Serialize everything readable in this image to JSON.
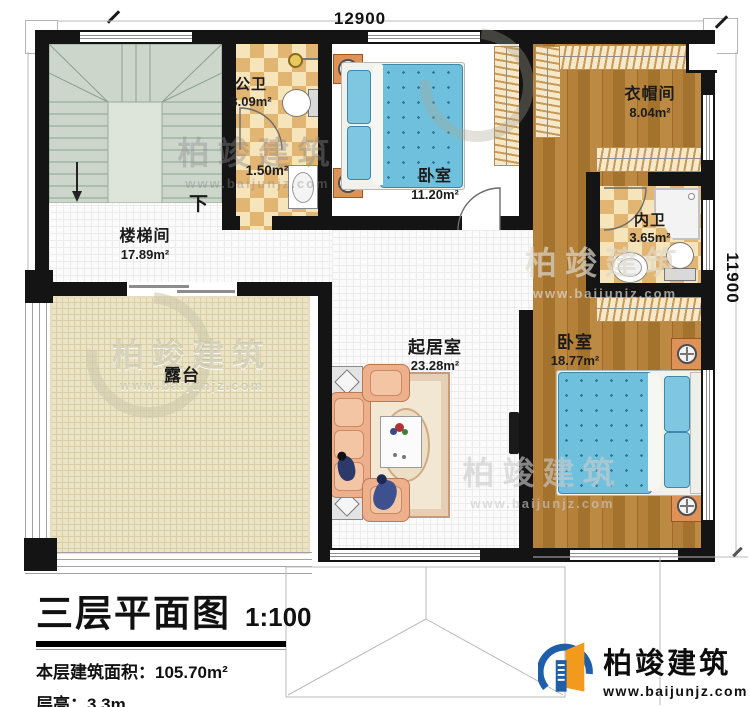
{
  "plan": {
    "dim_top": "12900",
    "dim_right": "11900",
    "stairs_down": "下"
  },
  "rooms": {
    "stairwell": {
      "name": "楼梯间",
      "area": "17.89m²"
    },
    "public_bath": {
      "name": "公卫",
      "area": "3.09m²"
    },
    "lobby": {
      "area": "1.50m²"
    },
    "bedroom1": {
      "name": "卧室",
      "area": "11.20m²"
    },
    "cloakroom": {
      "name": "衣帽间",
      "area": "8.04m²"
    },
    "private_bath": {
      "name": "内卫",
      "area": "3.65m²"
    },
    "bedroom2": {
      "name": "卧室",
      "area": "18.77m²"
    },
    "living": {
      "name": "起居室",
      "area": "23.28m²"
    },
    "terrace": {
      "name": "露台"
    }
  },
  "titleblock": {
    "title": "三层平面图",
    "scale": "1:100",
    "area_line": "本层建筑面积：105.70m²",
    "height_line": "层高：3.3m"
  },
  "brand": {
    "name": "柏竣建筑",
    "url": "www.baijunjz.com"
  },
  "colors": {
    "wall": "#141414",
    "wood_floor": "#ab7730",
    "bath_tile": "#e3b573",
    "terrace_tile": "#ece4c6",
    "bed_blue": "#6fc0dc",
    "brand_blue": "#1e5fa8",
    "brand_orange": "#f29a1d"
  }
}
